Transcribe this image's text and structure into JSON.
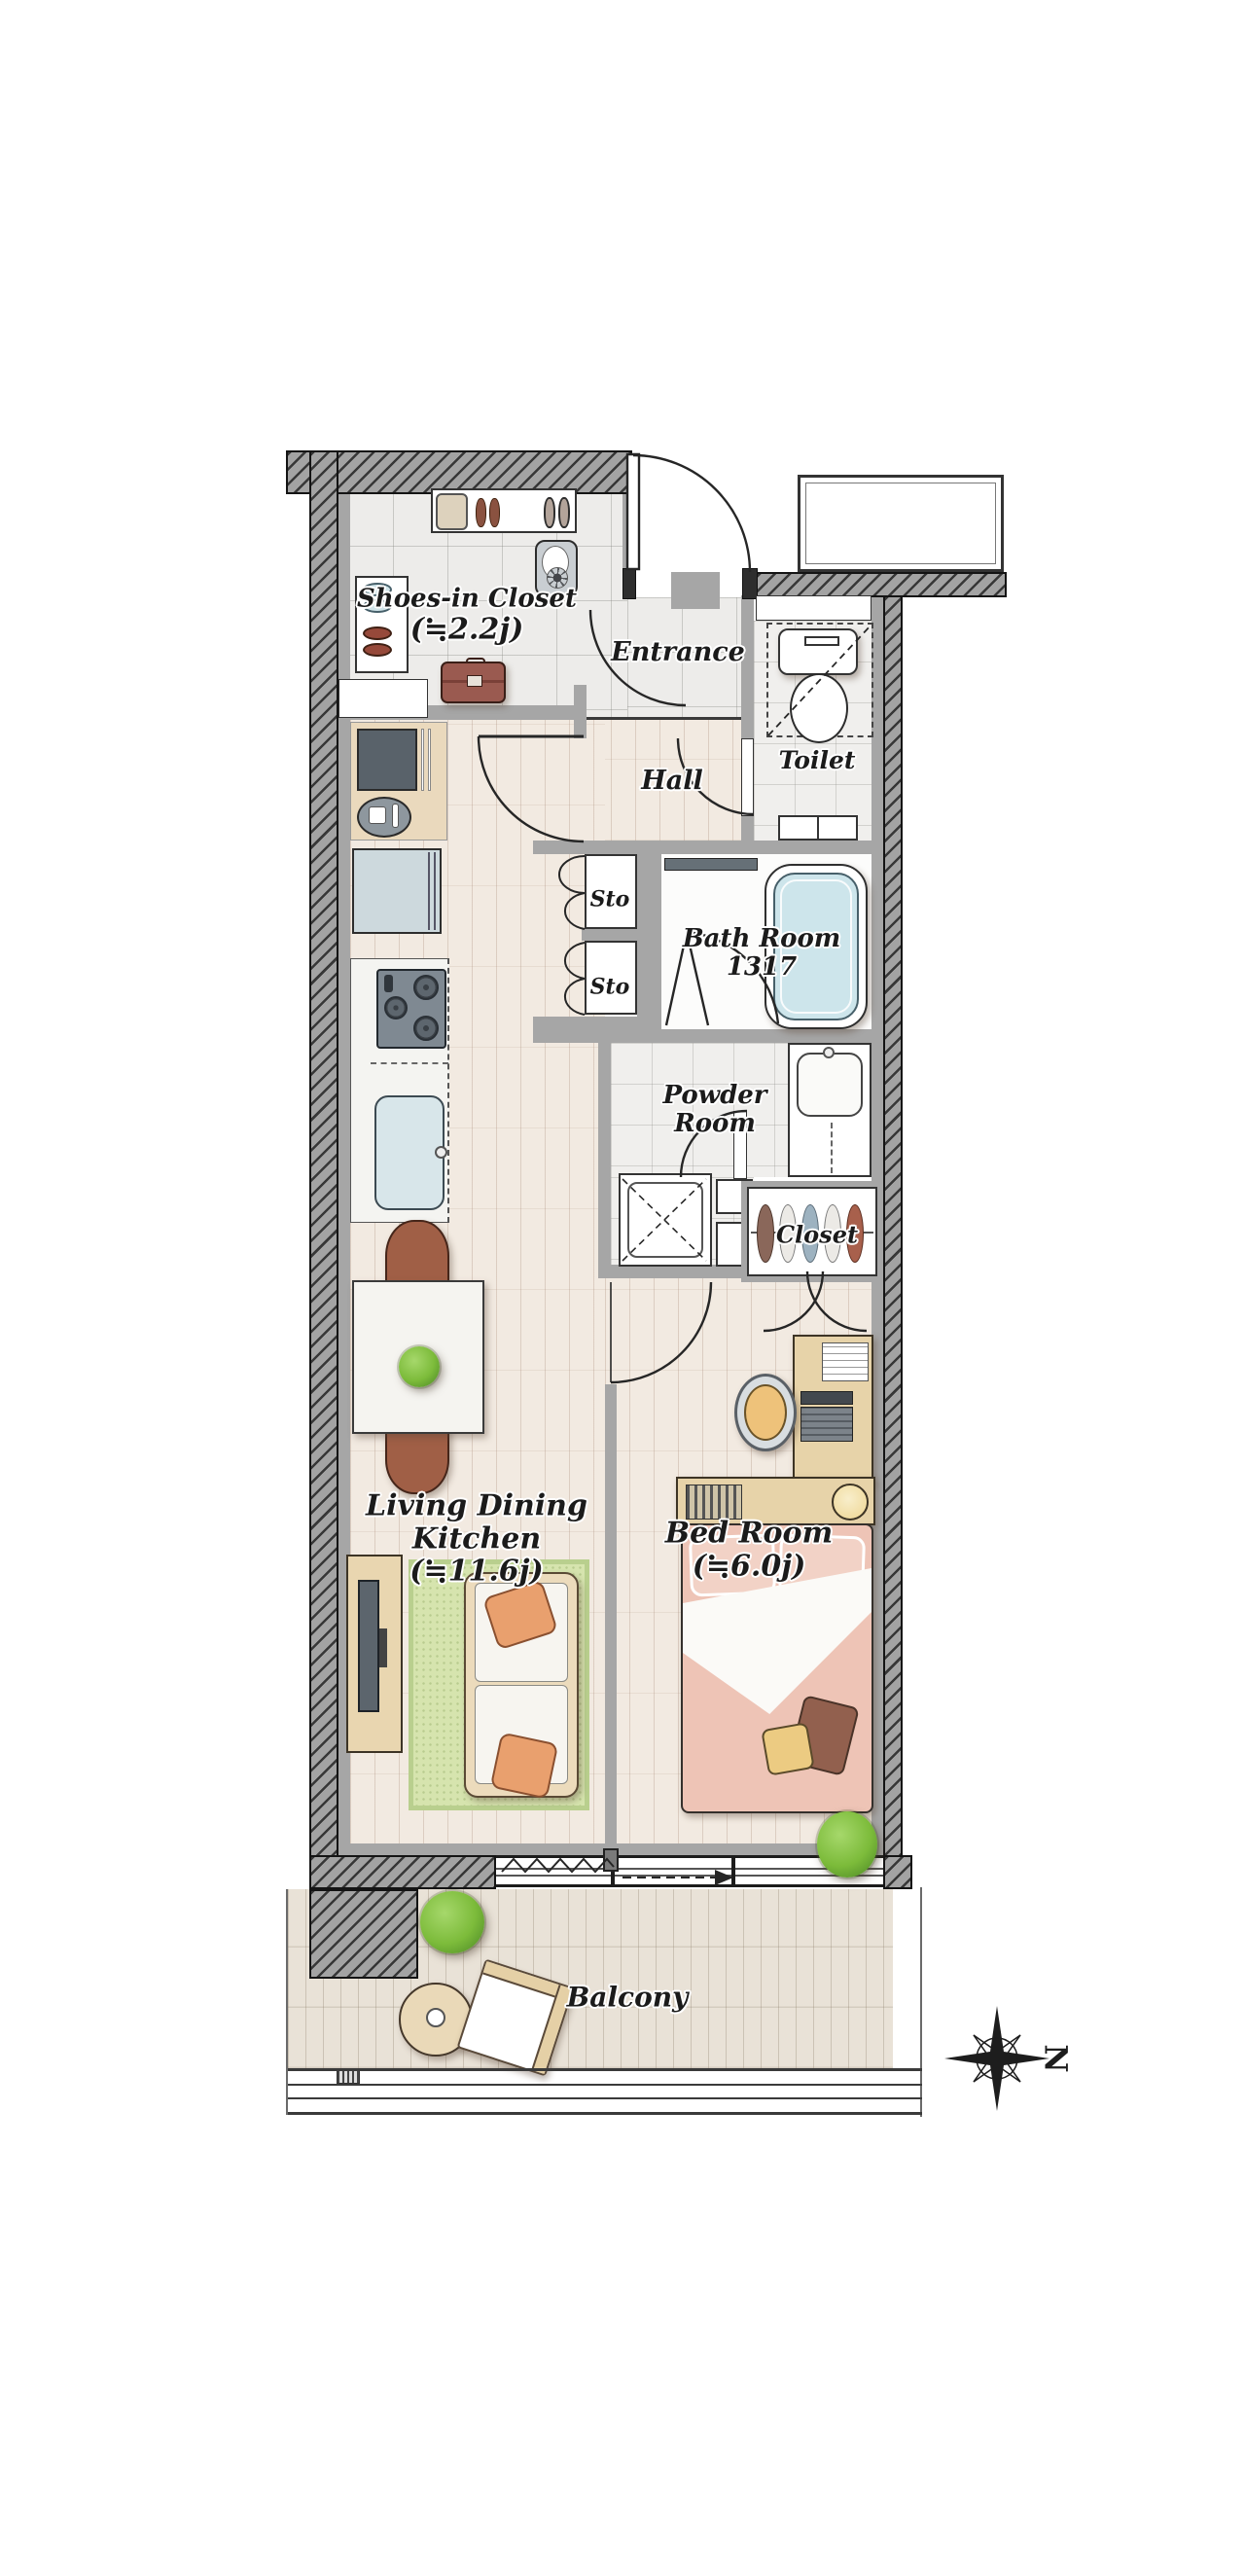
{
  "rooms": {
    "shoes_closet": {
      "label": "Shoes-in Closet",
      "size": "(≒2.2j)"
    },
    "entrance": {
      "label": "Entrance"
    },
    "hall": {
      "label": "Hall"
    },
    "toilet": {
      "label": "Toilet"
    },
    "storage_upper": {
      "label": "Sto"
    },
    "storage_lower": {
      "label": "Sto"
    },
    "bathroom": {
      "label": "Bath Room",
      "size": "1317"
    },
    "powder_room": {
      "label_line1": "Powder",
      "label_line2": "Room"
    },
    "closet": {
      "label": "Closet"
    },
    "ldk": {
      "label_line1": "Living Dining",
      "label_line2": "Kitchen",
      "size": "(≒11.6j)"
    },
    "bedroom": {
      "label": "Bed Room",
      "size": "(≒6.0j)"
    },
    "balcony": {
      "label": "Balcony"
    }
  },
  "compass": {
    "north_label": "N"
  },
  "colors": {
    "wall_hatch": "#a3a3a3",
    "interior_wall": "#a6a6a6",
    "wood_floor": "#f2eae1",
    "tile_floor": "#edecea",
    "balcony_deck": "#e9e2d7",
    "tub_water": "#cde5eb",
    "refrigerator": "#cdd9dd",
    "rug_green": "#d6e4ae",
    "sofa_frame": "#ecdbbc",
    "pillow_orange": "#e9a06e",
    "bed_pink": "#eec4b6",
    "furniture_beige": "#e7d3a9",
    "chair_brown": "#a05f46",
    "suitcase_red": "#9a5a50",
    "plant_green": "#7cbb3a"
  }
}
